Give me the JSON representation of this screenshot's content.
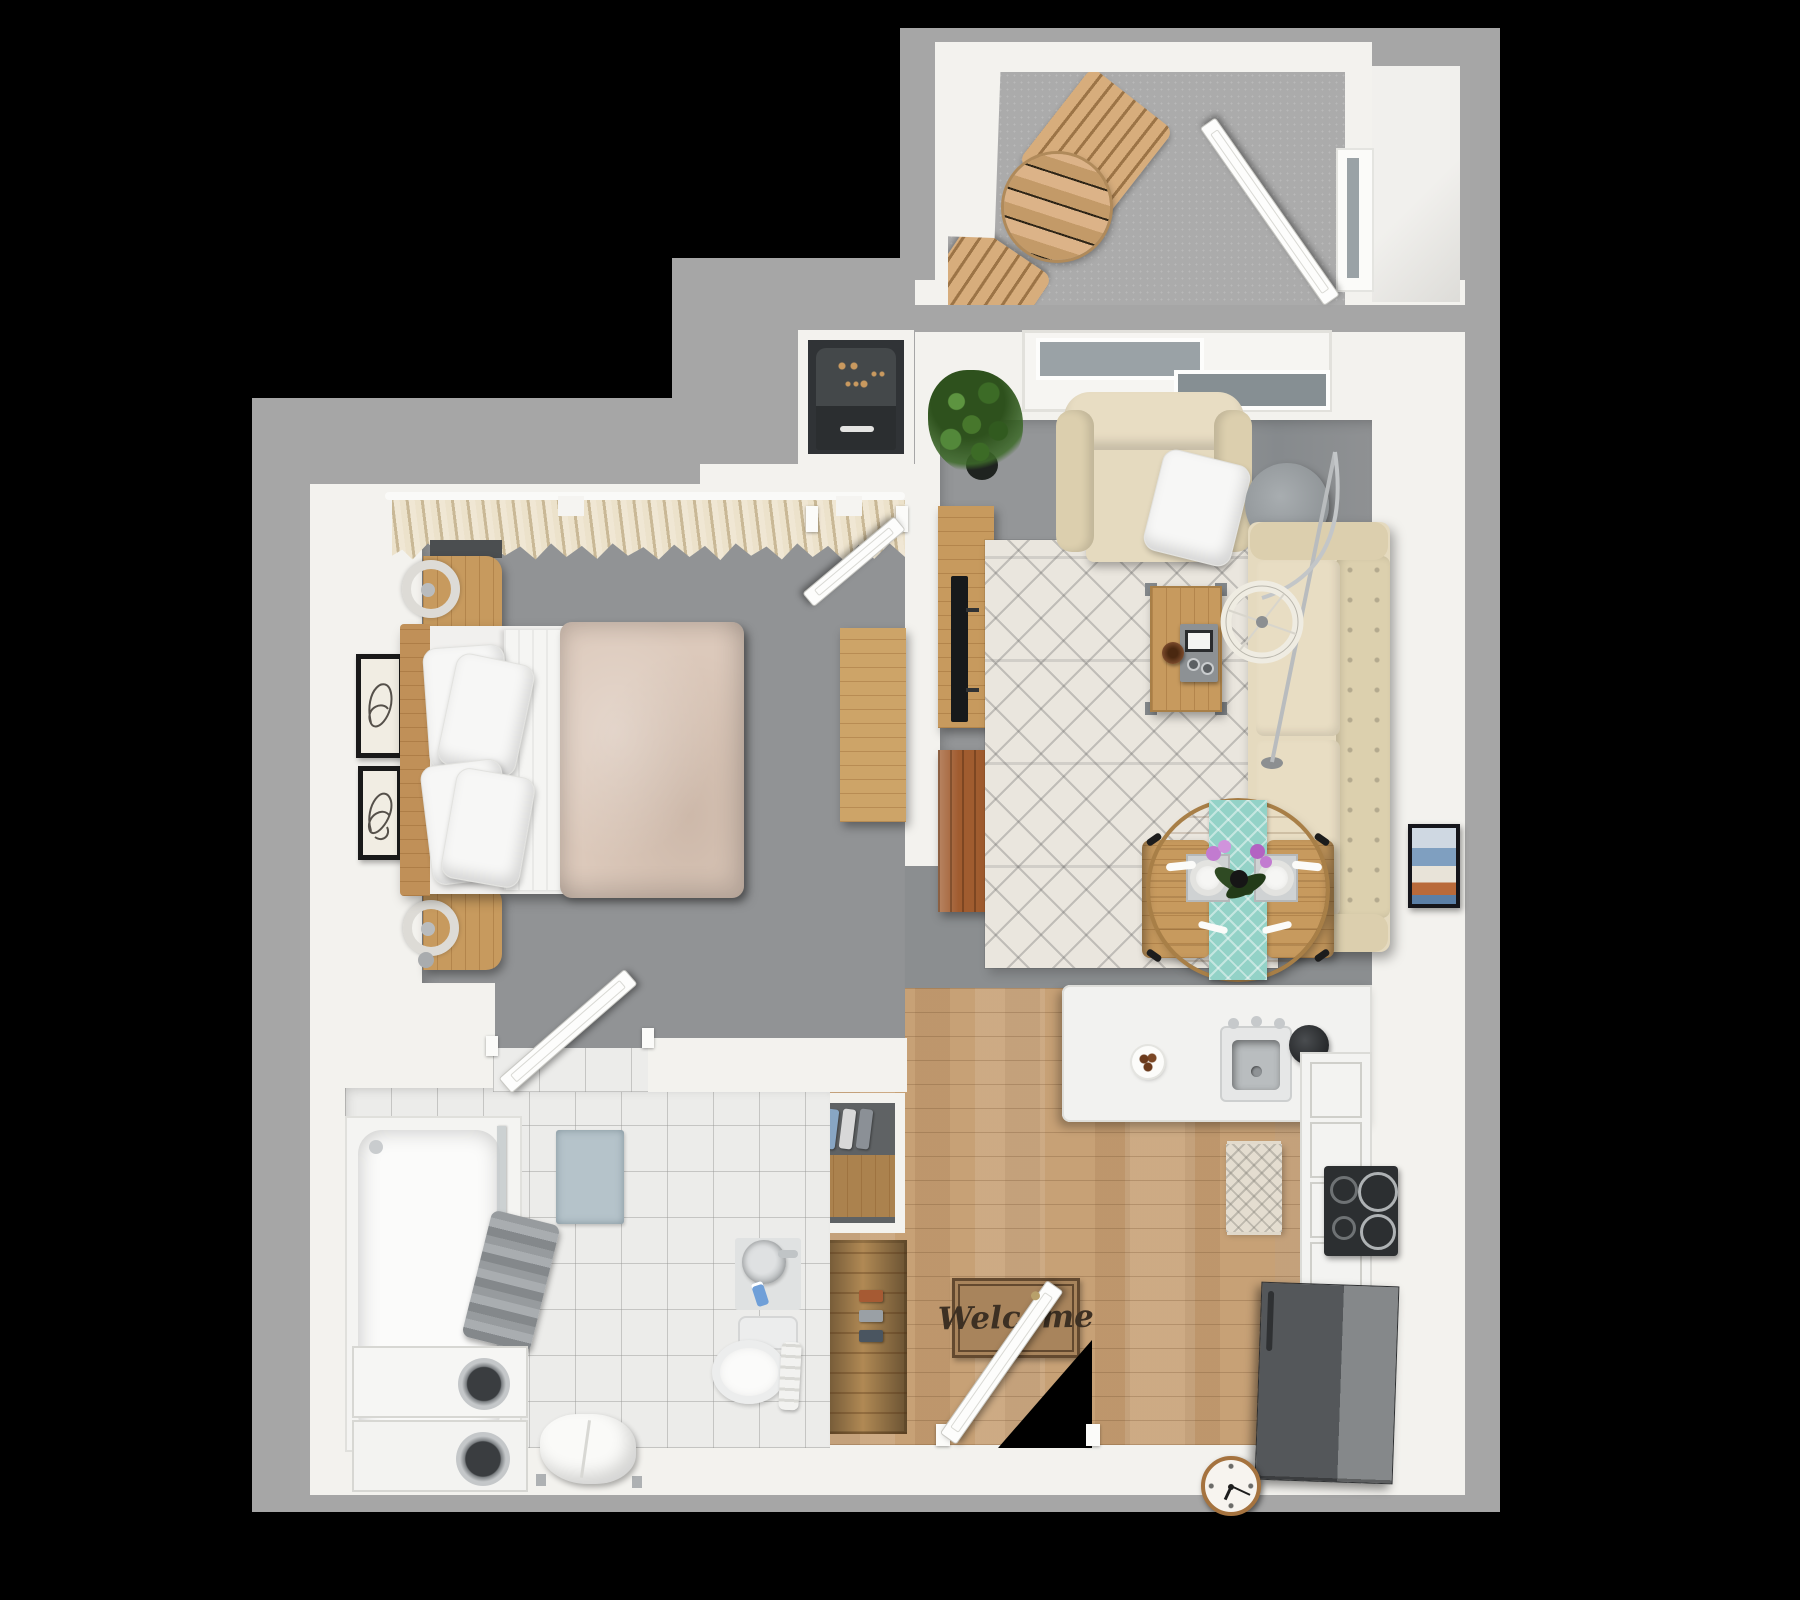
{
  "scene": {
    "description": "3D top-down rendered floor plan of a one-bedroom, one-bath apartment with balcony",
    "background": "#000000"
  },
  "colors": {
    "wall": "#f3f2ee",
    "wall_outer": "#a6a6a6",
    "carpet": "#8f9193",
    "tile": "#ececea",
    "wood_floor": "#c7a176",
    "wood": "#c79a5e",
    "beige": "#e5dabf",
    "cream_rug": "#eae6de",
    "duvet": "#dcc9bb",
    "teal": "#93d2c7",
    "appliance_dark": "#505356",
    "doormat": "#a8845c",
    "bathmat_blue": "#b5c3ca",
    "plant_green": "#47772c",
    "orchid_purple": "#c27bd0"
  },
  "entry": {
    "doormat_text": "Welcome"
  },
  "bathroom_closet": {
    "hanging_clothes_colors": [
      "#9aa0a5",
      "#a65a33",
      "#cdd1d4",
      "#9fc0d4",
      "#cbb9a4",
      "#a65a33",
      "#9aa0a5",
      "#e8e8e8",
      "#3f6fa8",
      "#88a6c4",
      "#d8d8d8",
      "#8b9096"
    ]
  },
  "entry_closet": {
    "folded_items_colors": [
      "#a65a33",
      "#9aa0a5",
      "#4a5560"
    ]
  },
  "clock": {
    "hour_angle_deg": 205,
    "minute_angle_deg": 115
  }
}
